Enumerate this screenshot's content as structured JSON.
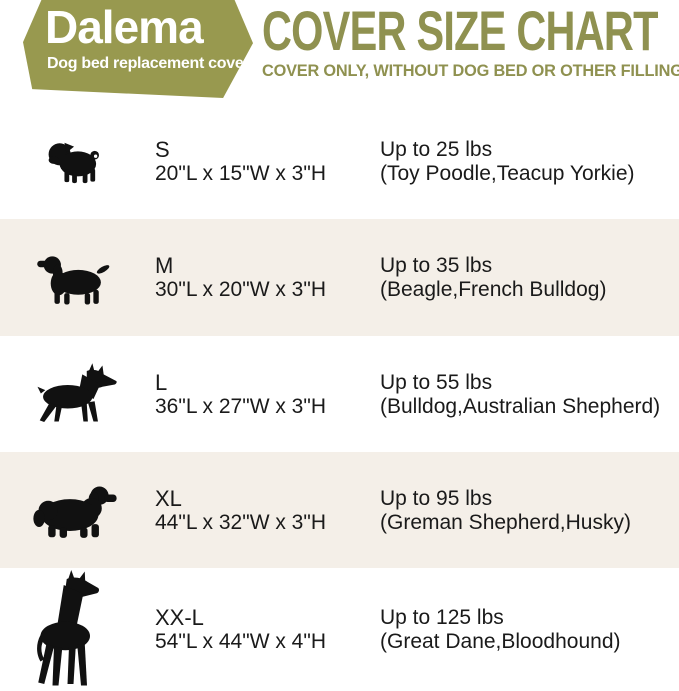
{
  "brand": {
    "name": "Dalema",
    "tagline": "Dog bed replacement cover"
  },
  "header": {
    "title": "COVER SIZE CHART",
    "subtitle": "COVER ONLY, WITHOUT DOG BED OR OTHER FILLINGS"
  },
  "colors": {
    "brand_olive": "#98994f",
    "title_olive": "#8f9150",
    "row_alternate": "#f4efe8",
    "text": "#1a1a1a",
    "silhouette": "#111111",
    "background": "#ffffff"
  },
  "rows": [
    {
      "size": "S",
      "dimensions": "20\"L x 15\"W x 3\"H",
      "weight": "Up to 25 lbs",
      "breeds": "(Toy Poodle,Teacup Yorkie)",
      "icon": "pug-icon"
    },
    {
      "size": "M",
      "dimensions": "30\"L x 20\"W x 3\"H",
      "weight": "Up to 35 lbs",
      "breeds": "(Beagle,French Bulldog)",
      "icon": "cocker-spaniel-icon"
    },
    {
      "size": "L",
      "dimensions": "36\"L x 27\"W x 3\"H",
      "weight": "Up to 55 lbs",
      "breeds": "(Bulldog,Australian Shepherd)",
      "icon": "doberman-icon"
    },
    {
      "size": "XL",
      "dimensions": "44\"L x 32\"W x 3\"H",
      "weight": "Up to 95 lbs",
      "breeds": "(Greman Shepherd,Husky)",
      "icon": "newfoundland-icon"
    },
    {
      "size": "XX-L",
      "dimensions": "54\"L x 44\"W x 4\"H",
      "weight": "Up to 125 lbs",
      "breeds": "(Great Dane,Bloodhound)",
      "icon": "great-dane-icon"
    }
  ],
  "chart_data": {
    "type": "table",
    "title": "COVER SIZE CHART",
    "subtitle": "COVER ONLY, WITHOUT DOG BED OR OTHER FILLINGS",
    "columns": [
      "size",
      "dimensions",
      "max_weight",
      "example_breeds"
    ],
    "rows": [
      [
        "S",
        "20\"L x 15\"W x 3\"H",
        "Up to 25 lbs",
        "Toy Poodle,Teacup Yorkie"
      ],
      [
        "M",
        "30\"L x 20\"W x 3\"H",
        "Up to 35 lbs",
        "Beagle,French Bulldog"
      ],
      [
        "L",
        "36\"L x 27\"W x 3\"H",
        "Up to 55 lbs",
        "Bulldog,Australian Shepherd"
      ],
      [
        "XL",
        "44\"L x 32\"W x 3\"H",
        "Up to 95 lbs",
        "Greman Shepherd,Husky"
      ],
      [
        "XX-L",
        "54\"L x 44\"W x 4\"H",
        "Up to 125 lbs",
        "Great Dane,Bloodhound"
      ]
    ]
  }
}
